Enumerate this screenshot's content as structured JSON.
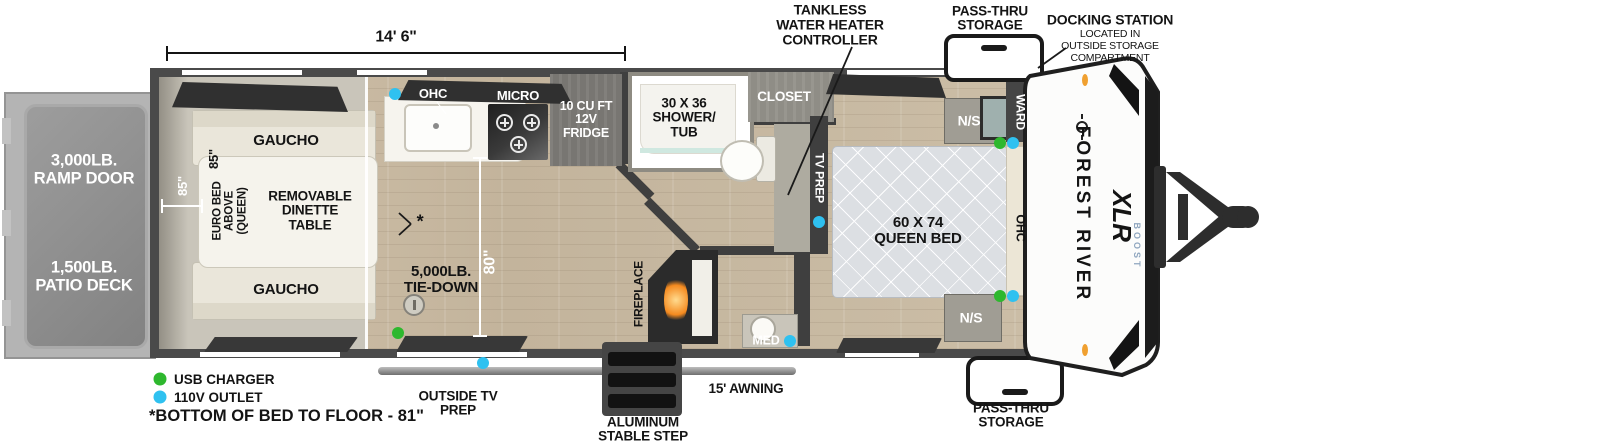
{
  "dims": {
    "length": "14' 6\"",
    "garage_height": "85\"",
    "bed_length": "85\"",
    "interior_width": "80\""
  },
  "exterior": {
    "ramp_door": "3,000LB.\nRAMP DOOR",
    "patio_deck": "1,500LB.\nPATIO DECK",
    "pass_thru_top": "PASS-THRU\nSTORAGE",
    "pass_thru_bottom": "PASS-THRU\nSTORAGE",
    "docking_title": "DOCKING STATION",
    "docking_sub": "LOCATED IN\nOUTSIDE STORAGE\nCOMPARTMENT",
    "tankless": "TANKLESS\nWATER HEATER\nCONTROLLER",
    "awning": "15' AWNING",
    "step": "ALUMINUM\nSTABLE STEP",
    "outside_tv": "OUTSIDE TV\nPREP",
    "brand": "FOREST RIVER",
    "model": "XLR",
    "model_sub": "BOOST"
  },
  "interior": {
    "gaucho_top": "GAUCHO",
    "gaucho_bottom": "GAUCHO",
    "euro_bed": "EURO BED\nABOVE\n(QUEEN)",
    "dinette": "REMOVABLE\nDINETTE\nTABLE",
    "tie_down": "5,000LB.\nTIE-DOWN",
    "asterisk": "*",
    "ohc_kitchen": "OHC",
    "micro": "MICRO",
    "fridge": "10 CU FT\n12V\nFRIDGE",
    "shower": "30 X 36\nSHOWER/\nTUB",
    "closet": "CLOSET",
    "fireplace": "FIREPLACE",
    "med": "MED",
    "tv_prep": "TV PREP",
    "queen_bed": "60 X 74\nQUEEN BED",
    "ns_top": "N/S",
    "ns_bottom": "N/S",
    "ward": "WARD",
    "ohc_bedroom": "OHC"
  },
  "legend": {
    "usb": "USB CHARGER",
    "outlet": "110V OUTLET",
    "note": "*BOTTOM OF BED TO FLOOR - 81\""
  },
  "colors": {
    "usb_dot": "#2eb82e",
    "outlet_dot": "#2fc1f0",
    "marker_orange": "#f0a030",
    "wall": "#3f3f3f"
  }
}
